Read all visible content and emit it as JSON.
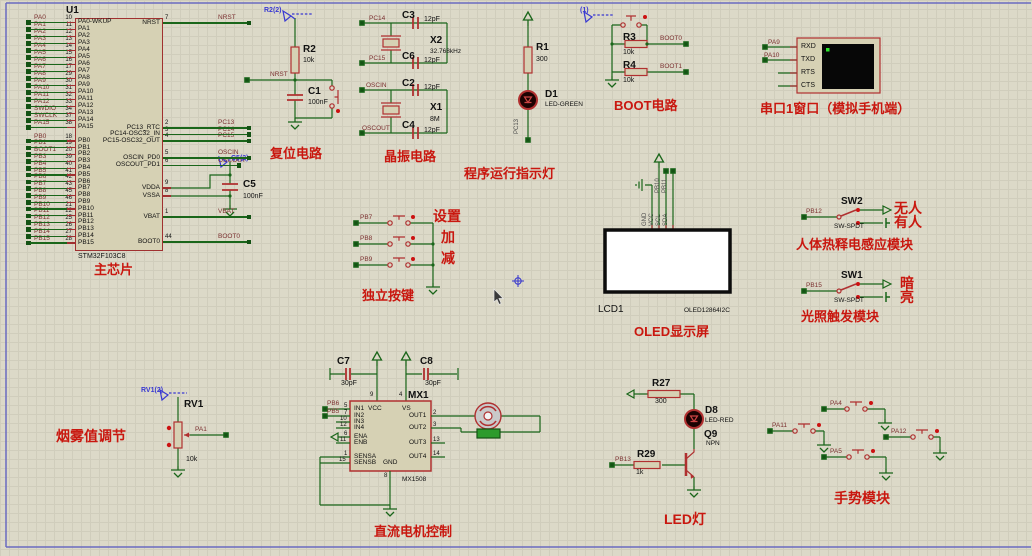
{
  "captions": {
    "chip": "主芯片",
    "reset": "复位电路",
    "crystal": "晶振电路",
    "runled": "程序运行指示灯",
    "boot": "BOOT电路",
    "serial": "串口1窗口（模拟手机端）",
    "keys": "独立按键",
    "oled": "OLED显示屏",
    "pir": "人体热释电感应模块",
    "light": "光照触发模块",
    "smoke": "烟雾值调节",
    "motor": "直流电机控制",
    "led": "LED灯",
    "gesture": "手势模块"
  },
  "colors": {
    "wire": "#1a661a",
    "component": "#b03030",
    "caption": "#c9170f",
    "net_label": "#7b3030",
    "probe_blue": "#3939d2",
    "sheet": "#dcd9c8",
    "screen_black": "#070707",
    "oled_white": "#ffffff"
  },
  "chip": {
    "ref": "U1",
    "part": "STM32F103C8",
    "pins_a": [
      [
        "PA0",
        "10",
        "PA0-WKUP"
      ],
      [
        "PA1",
        "11",
        "PA1"
      ],
      [
        "PA2",
        "12",
        "PA2"
      ],
      [
        "PA3",
        "13",
        "PA3"
      ],
      [
        "PA4",
        "14",
        "PA4"
      ],
      [
        "PA5",
        "15",
        "PA5"
      ],
      [
        "PA6",
        "16",
        "PA6"
      ],
      [
        "PA7",
        "17",
        "PA7"
      ],
      [
        "PA8",
        "29",
        "PA8"
      ],
      [
        "PA9",
        "30",
        "PA9"
      ],
      [
        "PA10",
        "31",
        "PA10"
      ],
      [
        "PA11",
        "32",
        "PA11"
      ],
      [
        "PA12",
        "33",
        "PA12"
      ],
      [
        "SWDIO",
        "34",
        "PA13"
      ],
      [
        "SWCLK",
        "37",
        "PA14"
      ],
      [
        "PA15",
        "38",
        "PA15"
      ]
    ],
    "pins_b": [
      [
        "PB0",
        "18",
        "PB0"
      ],
      [
        "PB1",
        "19",
        "PB1"
      ],
      [
        "BOOT1",
        "20",
        "PB2"
      ],
      [
        "PB3",
        "39",
        "PB3"
      ],
      [
        "PB4",
        "40",
        "PB4"
      ],
      [
        "PB5",
        "41",
        "PB5"
      ],
      [
        "PB6",
        "42",
        "PB6"
      ],
      [
        "PB7",
        "43",
        "PB7"
      ],
      [
        "PB8",
        "45",
        "PB8"
      ],
      [
        "PB9",
        "46",
        "PB9"
      ],
      [
        "PB10",
        "21",
        "PB10"
      ],
      [
        "PB11",
        "22",
        "PB11"
      ],
      [
        "PB12",
        "25",
        "PB12"
      ],
      [
        "PB13",
        "26",
        "PB13"
      ],
      [
        "PB14",
        "27",
        "PB14"
      ],
      [
        "PB15",
        "28",
        "PB15"
      ]
    ],
    "pins_right": [
      [
        "7",
        "NRST",
        "NRST"
      ],
      [
        "2",
        "PC13_RTC",
        "PC13"
      ],
      [
        "3",
        "PC14-OSC32_IN",
        "PC14"
      ],
      [
        "4",
        "PC15-OSC32_OUT",
        "PC15"
      ],
      [
        "5",
        "OSCIN_PD0",
        "OSCIN"
      ],
      [
        "6",
        "OSCOUT_PD1",
        "OSCOUT"
      ],
      [
        "9",
        "VDDA",
        ""
      ],
      [
        "8",
        "VSSA",
        ""
      ],
      [
        "1",
        "VBAT",
        "VBAT"
      ],
      [
        "44",
        "BOOT0",
        "BOOT0"
      ]
    ]
  },
  "texts": [
    [
      "probe-r2-label",
      "R2(2)",
      264,
      7,
      "blue"
    ],
    [
      "net-nrst",
      "NRST",
      270,
      72,
      "net"
    ],
    [
      "ref-r2",
      "R2",
      303,
      45,
      "ref"
    ],
    [
      "val-r2",
      "10k",
      303,
      57,
      "val"
    ],
    [
      "ref-c1",
      "C1",
      308,
      87,
      "ref"
    ],
    [
      "val-c1",
      "100nF",
      308,
      99,
      "val"
    ],
    [
      "net-pc14",
      "PC14",
      369,
      16,
      "net"
    ],
    [
      "ref-c3",
      "C3",
      402,
      11,
      "ref"
    ],
    [
      "val-c3",
      "12pF",
      424,
      16,
      "val"
    ],
    [
      "ref-x2",
      "X2",
      430,
      36,
      "ref"
    ],
    [
      "val-x2",
      "32.768kHz",
      430,
      49,
      "tiny"
    ],
    [
      "net-pc15",
      "PC15",
      369,
      56,
      "net"
    ],
    [
      "ref-c6",
      "C6",
      402,
      52,
      "ref"
    ],
    [
      "val-c6",
      "12pF",
      424,
      57,
      "val"
    ],
    [
      "net-oscin",
      "OSCIN",
      366,
      83,
      "net"
    ],
    [
      "ref-c2",
      "C2",
      402,
      79,
      "ref"
    ],
    [
      "val-c2",
      "12pF",
      424,
      84,
      "val"
    ],
    [
      "ref-x1",
      "X1",
      430,
      103,
      "ref"
    ],
    [
      "val-x1",
      "8M",
      430,
      116,
      "val"
    ],
    [
      "net-oscout",
      "OSCOUT",
      362,
      126,
      "net"
    ],
    [
      "ref-c4",
      "C4",
      402,
      121,
      "ref"
    ],
    [
      "val-c4",
      "12pF",
      424,
      127,
      "val"
    ],
    [
      "probe-c5-label",
      "C5(2)",
      231,
      155,
      "blue"
    ],
    [
      "ref-c5",
      "C5",
      243,
      180,
      "ref"
    ],
    [
      "val-c5",
      "100nF",
      243,
      193,
      "val"
    ],
    [
      "ref-r1",
      "R1",
      536,
      43,
      "ref"
    ],
    [
      "val-r1",
      "300",
      536,
      56,
      "val"
    ],
    [
      "ref-d1",
      "D1",
      545,
      90,
      "ref"
    ],
    [
      "val-d1",
      "LED-GREEN",
      545,
      102,
      "tiny"
    ],
    [
      "probe-boot-label",
      "(1)",
      580,
      7,
      "blue"
    ],
    [
      "ref-r3",
      "R3",
      623,
      33,
      "ref"
    ],
    [
      "val-r3",
      "10k",
      623,
      49,
      "val"
    ],
    [
      "net-boot0",
      "BOOT0",
      660,
      36,
      "net"
    ],
    [
      "ref-r4",
      "R4",
      623,
      61,
      "ref"
    ],
    [
      "val-r4",
      "10k",
      623,
      77,
      "val"
    ],
    [
      "net-boot1",
      "BOOT1",
      660,
      64,
      "net"
    ],
    [
      "net-pa9",
      "PA9",
      768,
      40,
      "net"
    ],
    [
      "net-pa10",
      "PA10",
      764,
      53,
      "net"
    ],
    [
      "pin-rxd",
      "RXD",
      801,
      43,
      "pn"
    ],
    [
      "pin-txd",
      "TXD",
      801,
      56,
      "pn"
    ],
    [
      "pin-rts",
      "RTS",
      801,
      69,
      "pn"
    ],
    [
      "pin-cts",
      "CTS",
      801,
      82,
      "pn"
    ],
    [
      "net-pb7",
      "PB7",
      360,
      215,
      "net"
    ],
    [
      "net-pb8",
      "PB8",
      360,
      236,
      "net"
    ],
    [
      "net-pb9",
      "PB9",
      360,
      257,
      "net"
    ],
    [
      "key-set-label",
      "设置",
      433,
      209,
      "cnb"
    ],
    [
      "key-inc-label",
      "加",
      441,
      230,
      "cnb"
    ],
    [
      "key-dec-label",
      "减",
      441,
      251,
      "cnb"
    ],
    [
      "ref-lcd1",
      "LCD1",
      598,
      305,
      "blk10"
    ],
    [
      "val-oled",
      "OLED12864I2C",
      684,
      308,
      "tiny"
    ],
    [
      "ref-sw2",
      "SW2",
      841,
      197,
      "ref"
    ],
    [
      "net-pb12",
      "PB12",
      806,
      209,
      "net"
    ],
    [
      "val-sw2",
      "SW-SPDT",
      834,
      224,
      "tiny"
    ],
    [
      "sw2-nobody-label",
      "无人",
      894,
      201,
      "cnb"
    ],
    [
      "sw2-somebody-label",
      "有人",
      894,
      215,
      "cnb"
    ],
    [
      "ref-sw1",
      "SW1",
      841,
      271,
      "ref"
    ],
    [
      "net-pb15",
      "PB15",
      806,
      283,
      "net"
    ],
    [
      "val-sw1",
      "SW-SPDT",
      834,
      298,
      "tiny"
    ],
    [
      "sw1-dark-label",
      "暗",
      900,
      276,
      "cnb"
    ],
    [
      "sw1-bright-label",
      "亮",
      900,
      290,
      "cnb"
    ],
    [
      "probe-rv1-label",
      "RV1(2)",
      141,
      387,
      "blue"
    ],
    [
      "ref-rv1",
      "RV1",
      184,
      400,
      "ref"
    ],
    [
      "net-pa1",
      "PA1",
      195,
      427,
      "net"
    ],
    [
      "val-rv1",
      "10k",
      186,
      456,
      "val"
    ],
    [
      "ref-c7",
      "C7",
      337,
      357,
      "ref"
    ],
    [
      "val-c7",
      "30pF",
      341,
      380,
      "val"
    ],
    [
      "ref-c8",
      "C8",
      420,
      357,
      "ref"
    ],
    [
      "val-c8",
      "30pF",
      425,
      380,
      "val"
    ],
    [
      "ref-mx1",
      "MX1",
      408,
      391,
      "ref"
    ],
    [
      "val-mx1",
      "MX1508",
      402,
      477,
      "tiny"
    ],
    [
      "net-pb6",
      "PB6",
      327,
      401,
      "net"
    ],
    [
      "net-pb5",
      "PB5",
      327,
      409,
      "net"
    ],
    [
      "mx-in1",
      "IN1",
      354,
      406,
      "pname2"
    ],
    [
      "mx-in2",
      "IN2",
      354,
      413,
      "pname2"
    ],
    [
      "mx-in3",
      "IN3",
      354,
      419,
      "pname2"
    ],
    [
      "mx-in4",
      "IN4",
      354,
      425,
      "pname2"
    ],
    [
      "mx-ena",
      "ENA",
      354,
      434,
      "pname2"
    ],
    [
      "mx-enb",
      "ENB",
      354,
      440,
      "pname2"
    ],
    [
      "mx-sensa",
      "SENSA",
      354,
      454,
      "pname2"
    ],
    [
      "mx-sensb",
      "SENSB",
      354,
      460,
      "pname2"
    ],
    [
      "mx-vcc",
      "VCC",
      368,
      406,
      "pname2"
    ],
    [
      "mx-vs",
      "VS",
      402,
      406,
      "pname2"
    ],
    [
      "mx-gnd",
      "GND",
      383,
      460,
      "pname2"
    ],
    [
      "mx-out1",
      "OUT1",
      409,
      413,
      "pname2"
    ],
    [
      "mx-out2",
      "OUT2",
      409,
      425,
      "pname2"
    ],
    [
      "mx-out3",
      "OUT3",
      409,
      440,
      "pname2"
    ],
    [
      "mx-out4",
      "OUT4",
      409,
      454,
      "pname2"
    ],
    [
      "mxn-in1",
      "5",
      344,
      403,
      "pnum2"
    ],
    [
      "mxn-in2",
      "7",
      344,
      410,
      "pnum2"
    ],
    [
      "mxn-in3",
      "10",
      340,
      416,
      "pnum2"
    ],
    [
      "mxn-in4",
      "12",
      340,
      422,
      "pnum2"
    ],
    [
      "mxn-ena",
      "6",
      344,
      431,
      "pnum2"
    ],
    [
      "mxn-enb",
      "11",
      340,
      437,
      "pnum2"
    ],
    [
      "mxn-sensa",
      "1",
      344,
      451,
      "pnum2"
    ],
    [
      "mxn-sensb",
      "15",
      339,
      457,
      "pnum2"
    ],
    [
      "mxn-vcc",
      "9",
      370,
      392,
      "pnum2"
    ],
    [
      "mxn-vs",
      "4",
      399,
      392,
      "pnum2"
    ],
    [
      "mxn-out1",
      "2",
      433,
      410,
      "pnum2"
    ],
    [
      "mxn-out2",
      "3",
      433,
      422,
      "pnum2"
    ],
    [
      "mxn-out3",
      "13",
      433,
      437,
      "pnum2"
    ],
    [
      "mxn-out4",
      "14",
      433,
      451,
      "pnum2"
    ],
    [
      "mxn-gnd",
      "8",
      384,
      473,
      "pnum2"
    ],
    [
      "ref-r27",
      "R27",
      652,
      379,
      "ref"
    ],
    [
      "val-r27",
      "300",
      655,
      398,
      "val"
    ],
    [
      "ref-d8",
      "D8",
      705,
      406,
      "ref"
    ],
    [
      "val-d8",
      "LED-RED",
      705,
      418,
      "tiny"
    ],
    [
      "ref-q9",
      "Q9",
      704,
      430,
      "ref"
    ],
    [
      "val-q9",
      "NPN",
      706,
      441,
      "tiny"
    ],
    [
      "ref-r29",
      "R29",
      637,
      450,
      "ref"
    ],
    [
      "val-r29",
      "1k",
      636,
      469,
      "val"
    ],
    [
      "net-pb13",
      "PB13",
      615,
      457,
      "net"
    ],
    [
      "net-pa4",
      "PA4",
      830,
      401,
      "net"
    ],
    [
      "net-pa11",
      "PA11",
      772,
      423,
      "net"
    ],
    [
      "net-pa12",
      "PA12",
      891,
      429,
      "net"
    ],
    [
      "net-pa5",
      "PA5",
      830,
      449,
      "net"
    ]
  ],
  "rtexts": [
    [
      "rot-pc13",
      "PC13",
      520,
      134
    ],
    [
      "rot-pb10",
      "PB10",
      661,
      193
    ],
    [
      "rot-pb11",
      "PB11",
      668,
      193
    ],
    [
      "rot-oled-gnd",
      "GND",
      648,
      226
    ],
    [
      "rot-oled-vcc",
      "VCC",
      655,
      226
    ],
    [
      "rot-oled-scl",
      "SCL",
      662,
      226
    ],
    [
      "rot-oled-sda",
      "SDA",
      669,
      226
    ]
  ]
}
